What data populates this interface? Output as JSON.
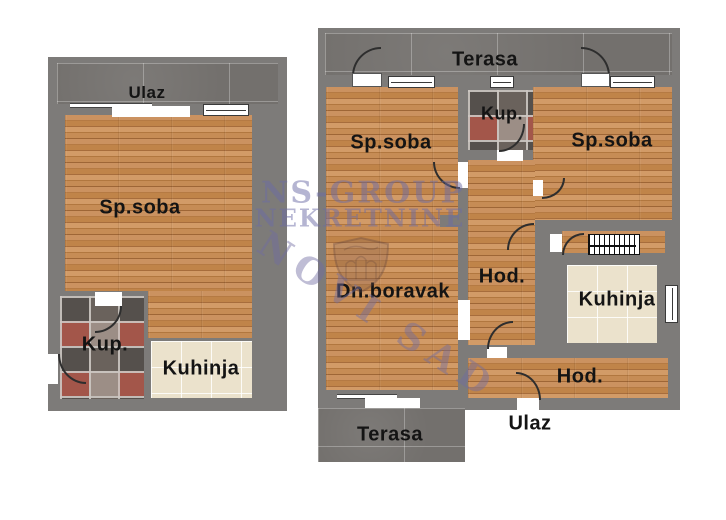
{
  "plan_left": {
    "labels": {
      "ulaz": "Ulaz",
      "sp_soba": "Sp.soba",
      "kup": "Kup.",
      "kuhinja": "Kuhinja"
    }
  },
  "plan_right": {
    "labels": {
      "terasa_top": "Terasa",
      "sp_soba_left": "Sp.soba",
      "kup": "Kup.",
      "sp_soba_right": "Sp.soba",
      "dn_boravak": "Dn.boravak",
      "hod": "Hod.",
      "kuhinja": "Kuhinja",
      "hod_bottom": "Hod.",
      "ulaz": "Ulaz",
      "terasa_bottom": "Terasa"
    }
  },
  "watermark": {
    "line1": "NS-GROUP",
    "line2": "NEKRETNINE",
    "stamp": "NOVI SAD"
  },
  "colors": {
    "wall": "#7d7b79",
    "wood": "#c08552",
    "tile_dark": "#73706d",
    "tile_cream": "#ebe2cc",
    "mosaic_accent": "#a3564a",
    "watermark": "#6c6ca5",
    "label_text": "#141414"
  }
}
